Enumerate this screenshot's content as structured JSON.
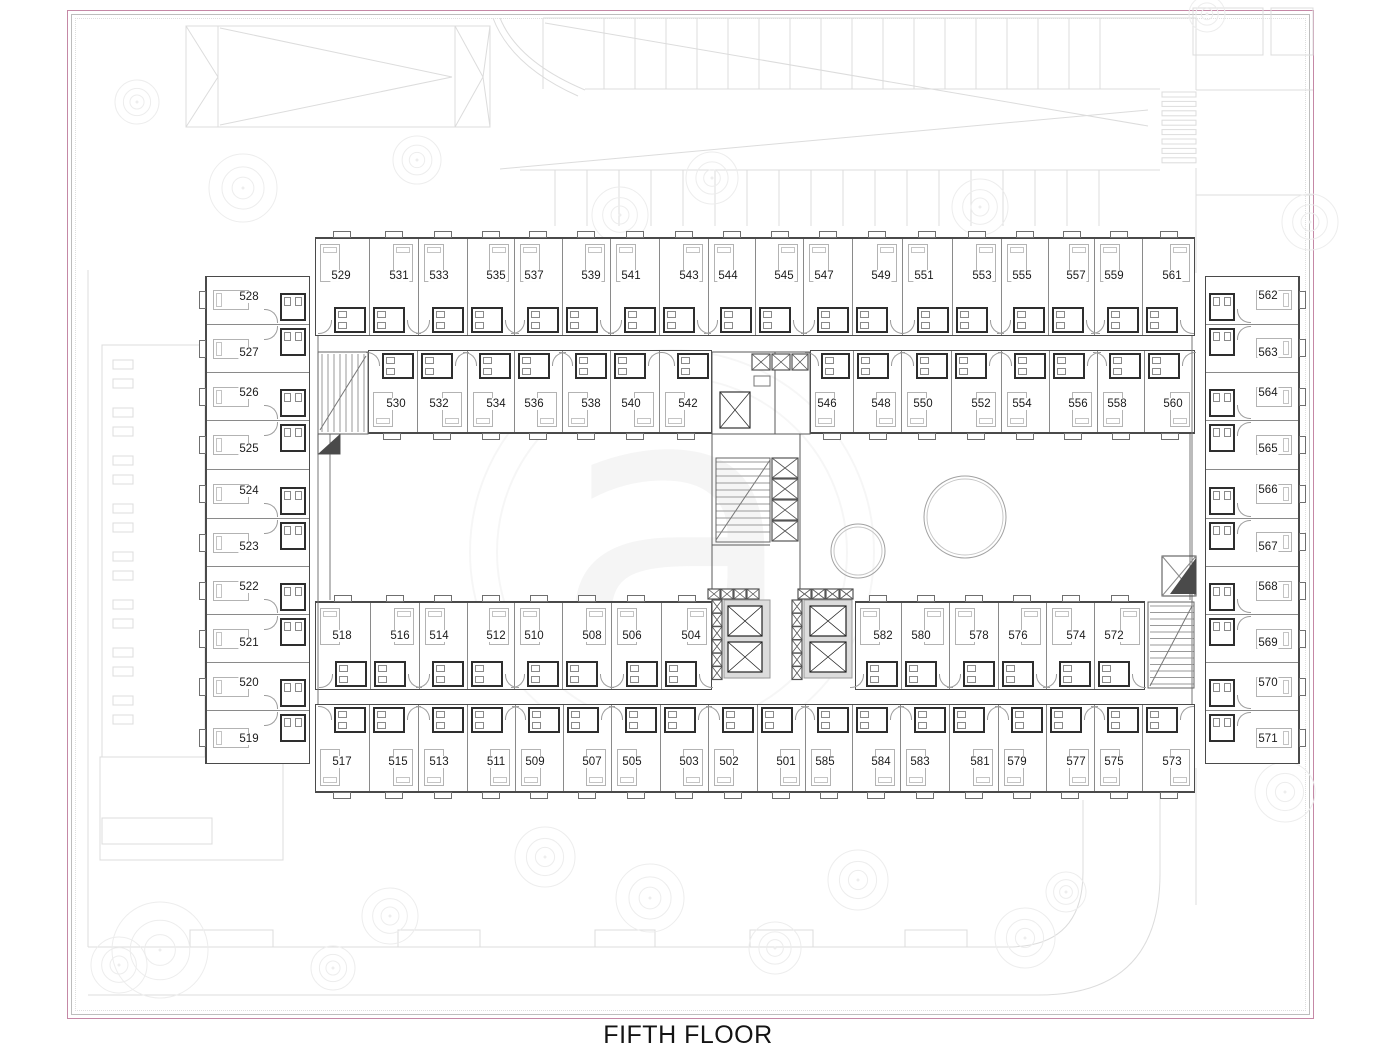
{
  "drawing": {
    "title": "FIFTH FLOOR",
    "watermark_glyph": "a"
  },
  "colors": {
    "frame_pink": "#c588a6",
    "wall_dark": "#4a4a4a",
    "wall_party": "#8a8a8a",
    "bath_wall": "#2e2e2e",
    "site_line": "#dcdcdc",
    "furniture": "#b3b3b3",
    "label_text": "#1b1b1b"
  },
  "rooms": {
    "row1": [
      "529",
      "531",
      "533",
      "535",
      "537",
      "539",
      "541",
      "543",
      "544",
      "545",
      "547",
      "549",
      "551",
      "553",
      "555",
      "557",
      "559",
      "561"
    ],
    "row2_left": [
      "530",
      "532",
      "534",
      "536",
      "538",
      "540",
      "542"
    ],
    "row2_right": [
      "546",
      "548",
      "550",
      "552",
      "554",
      "556",
      "558",
      "560"
    ],
    "row3_left": [
      "518",
      "516",
      "514",
      "512",
      "510",
      "508",
      "506",
      "504"
    ],
    "row3_right": [
      "582",
      "580",
      "578",
      "576",
      "574",
      "572"
    ],
    "row4": [
      "517",
      "515",
      "513",
      "511",
      "509",
      "507",
      "505",
      "503",
      "502",
      "501",
      "585",
      "584",
      "583",
      "581",
      "579",
      "577",
      "575",
      "573"
    ],
    "west_wing": [
      "528",
      "527",
      "526",
      "525",
      "524",
      "523",
      "522",
      "521",
      "520",
      "519"
    ],
    "east_wing": [
      "562",
      "563",
      "564",
      "565",
      "566",
      "567",
      "568",
      "569",
      "570",
      "571"
    ]
  }
}
